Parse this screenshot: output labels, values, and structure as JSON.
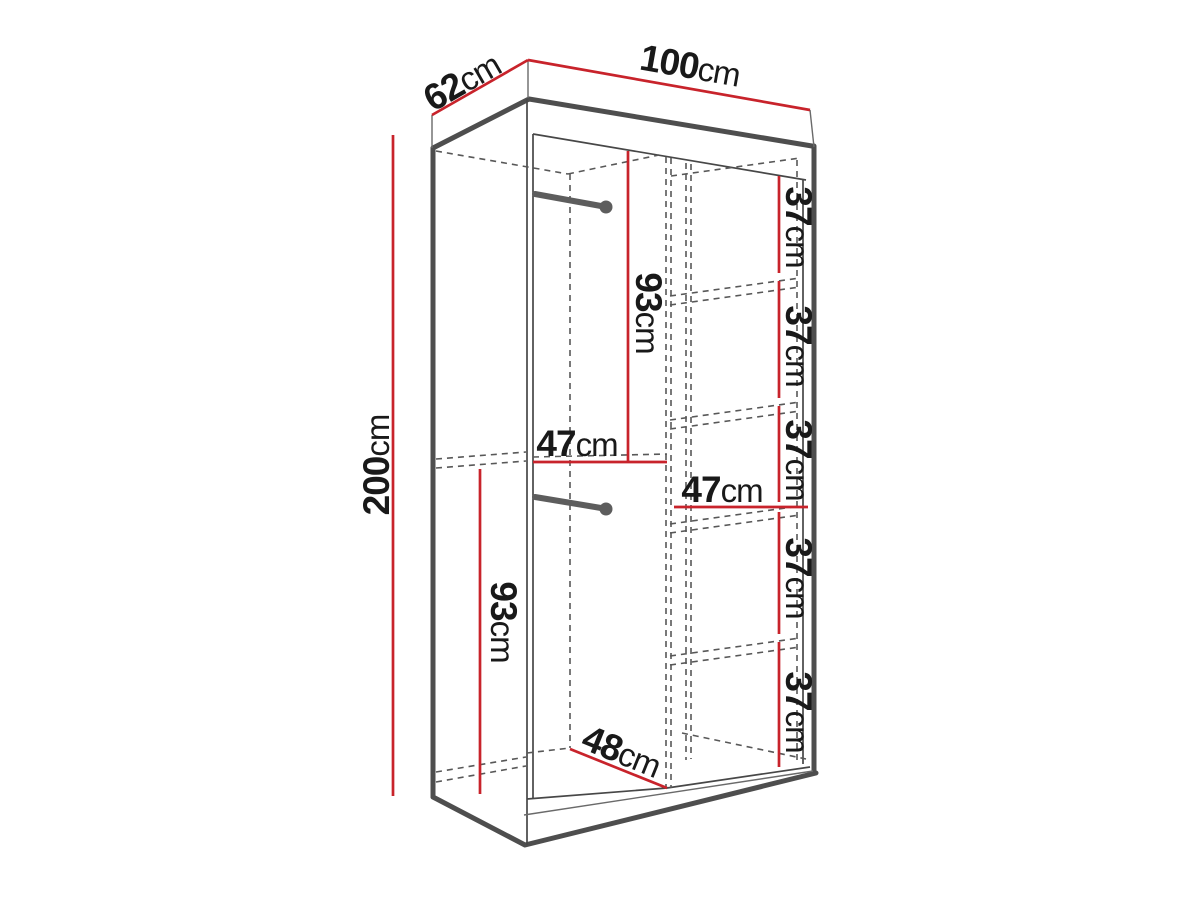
{
  "diagram": {
    "subject": "wardrobe-dimension-diagram",
    "unit": "cm",
    "colors": {
      "dimension_red": "#c8232b",
      "outline_gray": "#4e4e4e",
      "label_black": "#191919",
      "background": "#ffffff"
    },
    "overall": {
      "width_top": {
        "num": "100",
        "unit": "cm"
      },
      "depth_top": {
        "num": "62",
        "unit": "cm"
      },
      "height_left": {
        "num": "200",
        "unit": "cm"
      }
    },
    "interior": {
      "upper_hanging_height": {
        "num": "93",
        "unit": "cm"
      },
      "upper_section_width": {
        "num": "47",
        "unit": "cm"
      },
      "lower_hanging_height": {
        "num": "93",
        "unit": "cm"
      },
      "bottom_depth": {
        "num": "48",
        "unit": "cm"
      },
      "shelf_column_width": {
        "num": "47",
        "unit": "cm"
      },
      "shelf_gaps": [
        {
          "num": "37",
          "unit": "cm"
        },
        {
          "num": "37",
          "unit": "cm"
        },
        {
          "num": "37",
          "unit": "cm"
        },
        {
          "num": "37",
          "unit": "cm"
        },
        {
          "num": "37",
          "unit": "cm"
        }
      ]
    }
  }
}
